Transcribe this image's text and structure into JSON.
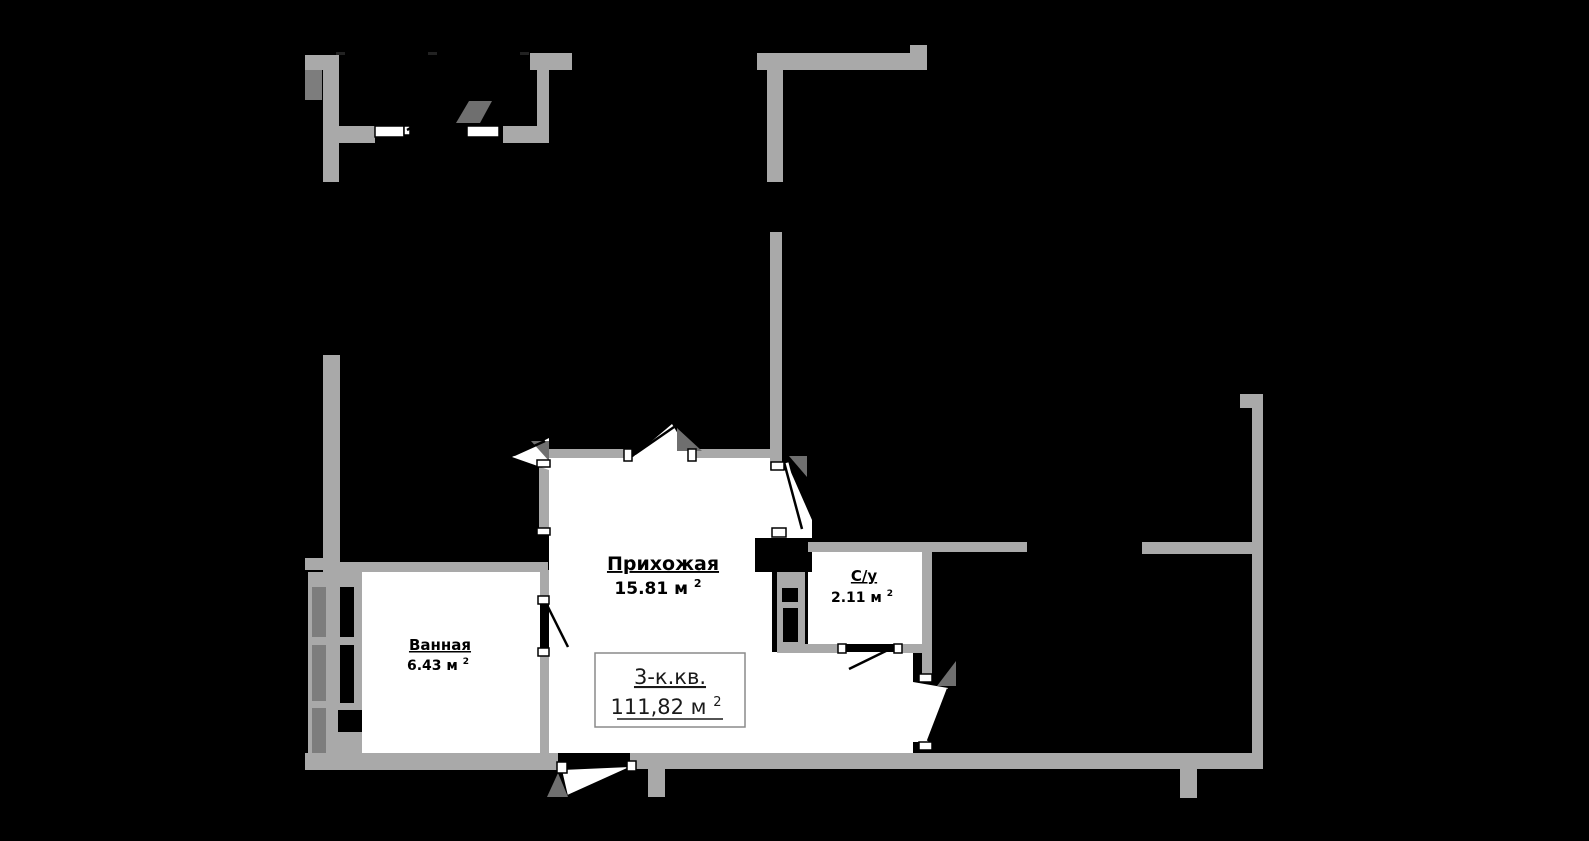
{
  "plan": {
    "apartment_box": {
      "type_label": "3-к.кв.",
      "total_area": "111,82 м",
      "total_area_sup": "2"
    },
    "rooms": [
      {
        "name": "Прихожая",
        "area": "15.81 м",
        "sup": "2"
      },
      {
        "name": "С/у",
        "area": "2.11 м",
        "sup": "2"
      },
      {
        "name": "Ванная",
        "area": "6.43 м",
        "sup": "2"
      }
    ],
    "colors": {
      "background": "#000000",
      "wall": "#a9a9a9",
      "wall_dark": "#7d7d7d",
      "room_fill": "#ffffff",
      "label_text": "#000000",
      "box_border": "#8a8a8a"
    }
  }
}
